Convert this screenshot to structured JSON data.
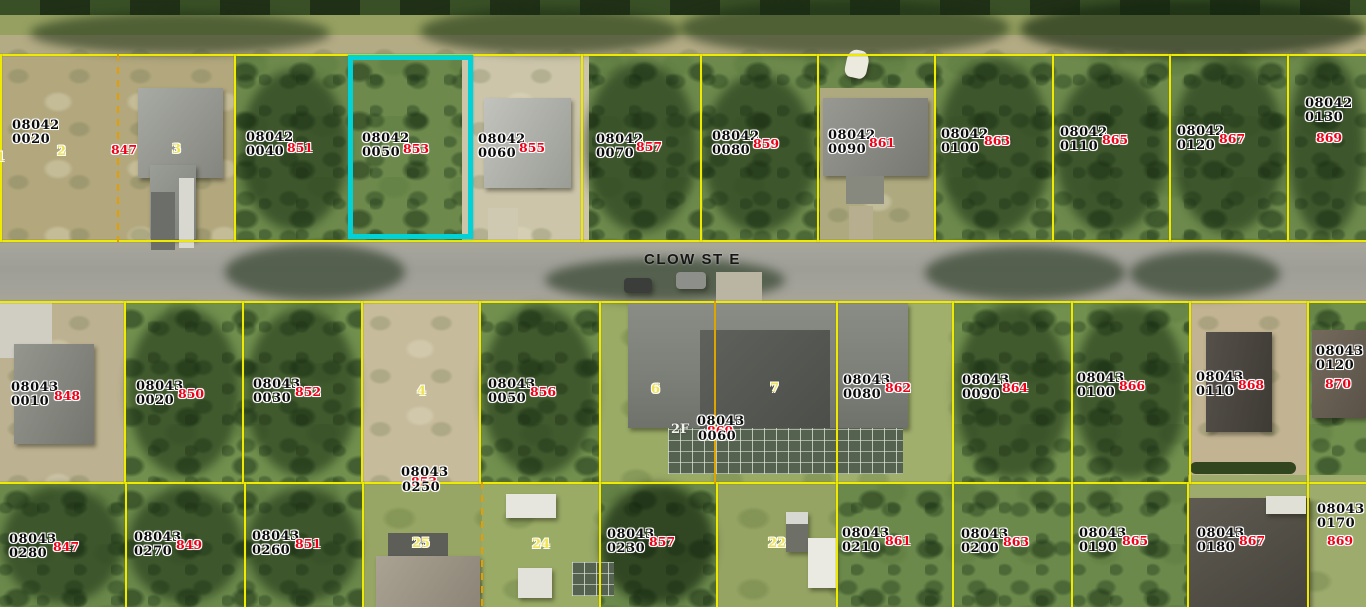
{
  "map": {
    "type": "aerial-parcel-map",
    "street": {
      "name": "CLOW ST E"
    },
    "colors": {
      "parcel_line": "#eeea00",
      "lot_split_line": "#e0a400",
      "highlight": "#00d3d8",
      "parcel_id_text": "#0b0b0b",
      "address_text": "#ee0018",
      "lot_number_text": "#efe354"
    },
    "highlighted_parcel": {
      "block": "08042",
      "lot": "0050",
      "address": "853"
    }
  },
  "parcels": [
    {
      "block": "08042",
      "lot": "0020",
      "address": "847"
    },
    {
      "block": "08042",
      "lot": "0040",
      "address": "851"
    },
    {
      "block": "08042",
      "lot": "0050",
      "address": "853"
    },
    {
      "block": "08042",
      "lot": "0060",
      "address": "855"
    },
    {
      "block": "08042",
      "lot": "0070",
      "address": "857"
    },
    {
      "block": "08042",
      "lot": "0080",
      "address": "859"
    },
    {
      "block": "08042",
      "lot": "0090",
      "address": "861"
    },
    {
      "block": "08042",
      "lot": "0100",
      "address": "863"
    },
    {
      "block": "08042",
      "lot": "0110",
      "address": "865"
    },
    {
      "block": "08042",
      "lot": "0120",
      "address": "867"
    },
    {
      "block": "08042",
      "lot": "0130",
      "address": "869"
    },
    {
      "block": "08043",
      "lot": "0010",
      "address": "848"
    },
    {
      "block": "08043",
      "lot": "0020",
      "address": "850"
    },
    {
      "block": "08043",
      "lot": "0030",
      "address": "852"
    },
    {
      "block": "08043",
      "lot": "0050",
      "address": "856"
    },
    {
      "block": "08043",
      "lot": "0060",
      "address": "860"
    },
    {
      "block": "08043",
      "lot": "0080",
      "address": "862"
    },
    {
      "block": "08043",
      "lot": "0090",
      "address": "864"
    },
    {
      "block": "08043",
      "lot": "0100",
      "address": "866"
    },
    {
      "block": "08043",
      "lot": "0110",
      "address": "868"
    },
    {
      "block": "08043",
      "lot": "0120",
      "address": "870"
    },
    {
      "block": "08043",
      "lot": "0250",
      "address": "853"
    },
    {
      "block": "08043",
      "lot": "0280",
      "address": "847"
    },
    {
      "block": "08043",
      "lot": "0270",
      "address": "849"
    },
    {
      "block": "08043",
      "lot": "0260",
      "address": "851"
    },
    {
      "block": "08043",
      "lot": "0230",
      "address": "857"
    },
    {
      "block": "08043",
      "lot": "0210",
      "address": "861"
    },
    {
      "block": "08043",
      "lot": "0200",
      "address": "863"
    },
    {
      "block": "08043",
      "lot": "0190",
      "address": "865"
    },
    {
      "block": "08043",
      "lot": "0180",
      "address": "867"
    },
    {
      "block": "08043",
      "lot": "0170",
      "address": "869"
    }
  ],
  "lot_numbers": [
    {
      "value": "1"
    },
    {
      "value": "2"
    },
    {
      "value": "3"
    },
    {
      "value": "4"
    },
    {
      "value": "6"
    },
    {
      "value": "7"
    },
    {
      "value": "2F"
    },
    {
      "value": "25"
    },
    {
      "value": "24"
    },
    {
      "value": "22"
    }
  ]
}
